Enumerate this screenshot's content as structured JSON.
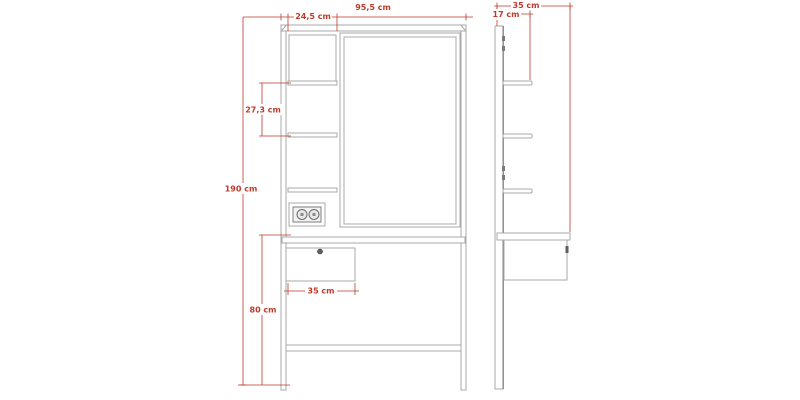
{
  "drawing_type": "furniture-technical-drawing",
  "colors": {
    "background": "#ffffff",
    "outline": "#a8a8a8",
    "outline_dark": "#7d7d7d",
    "dimension": "#c0392b"
  },
  "views": {
    "front": {
      "label": "front-elevation",
      "parts": [
        "frame",
        "mirror",
        "top-compartment",
        "shelves",
        "power-outlet",
        "desktop",
        "drawer",
        "stretcher-rail",
        "legs"
      ],
      "dimensions": {
        "overall_width": "95,5 cm",
        "top_compartment_width": "24,5 cm",
        "shelf_spacing": "27,3 cm",
        "overall_height": "190 cm",
        "drawer_width": "35 cm",
        "desk_height": "80 cm"
      }
    },
    "side": {
      "label": "side-elevation",
      "parts": [
        "back-panel",
        "shelves",
        "shelf-brackets",
        "desktop",
        "drawer",
        "leg"
      ],
      "dimensions": {
        "overall_depth": "35 cm",
        "shelf_depth": "17 cm"
      }
    }
  }
}
